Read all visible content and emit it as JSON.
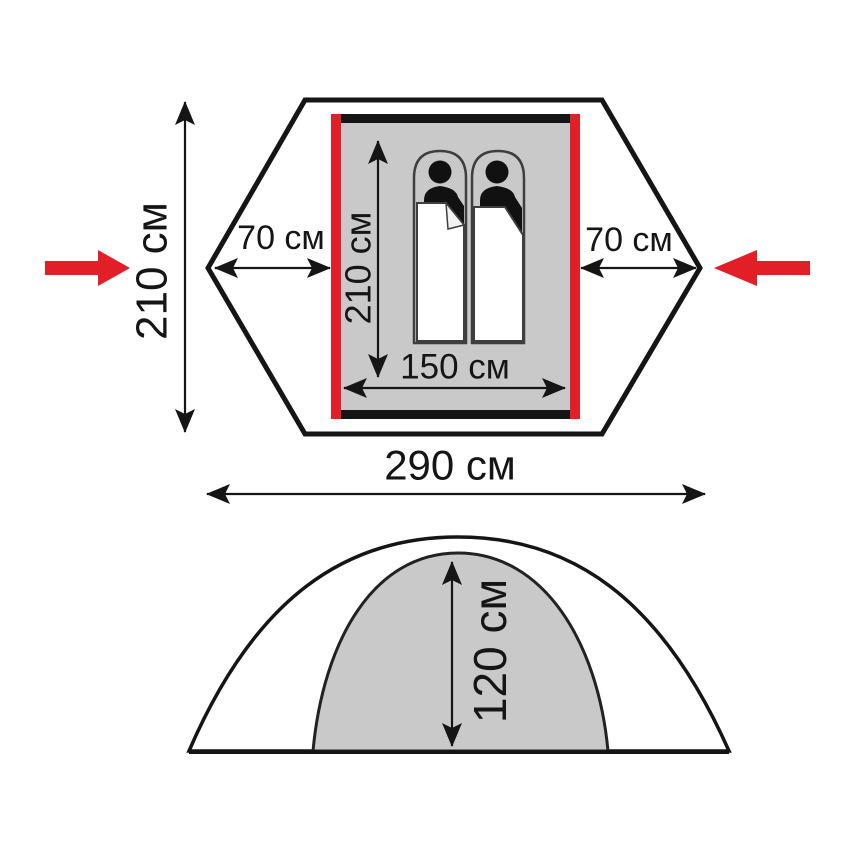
{
  "diagram_title": "tent-dimensions-diagram",
  "colors": {
    "accent_red": "#e21e26",
    "floor_gray": "#c9c9c9",
    "line_black": "#151515"
  },
  "labels": {
    "top_view": {
      "outer_depth": "210 см",
      "left_vestibule": "70 см",
      "right_vestibule": "70 см",
      "inner_length": "210 см",
      "inner_width": "150 см",
      "total_width": "290 см"
    },
    "side_view": {
      "height": "120 см"
    }
  },
  "icons": {
    "occupant_count": 2
  }
}
